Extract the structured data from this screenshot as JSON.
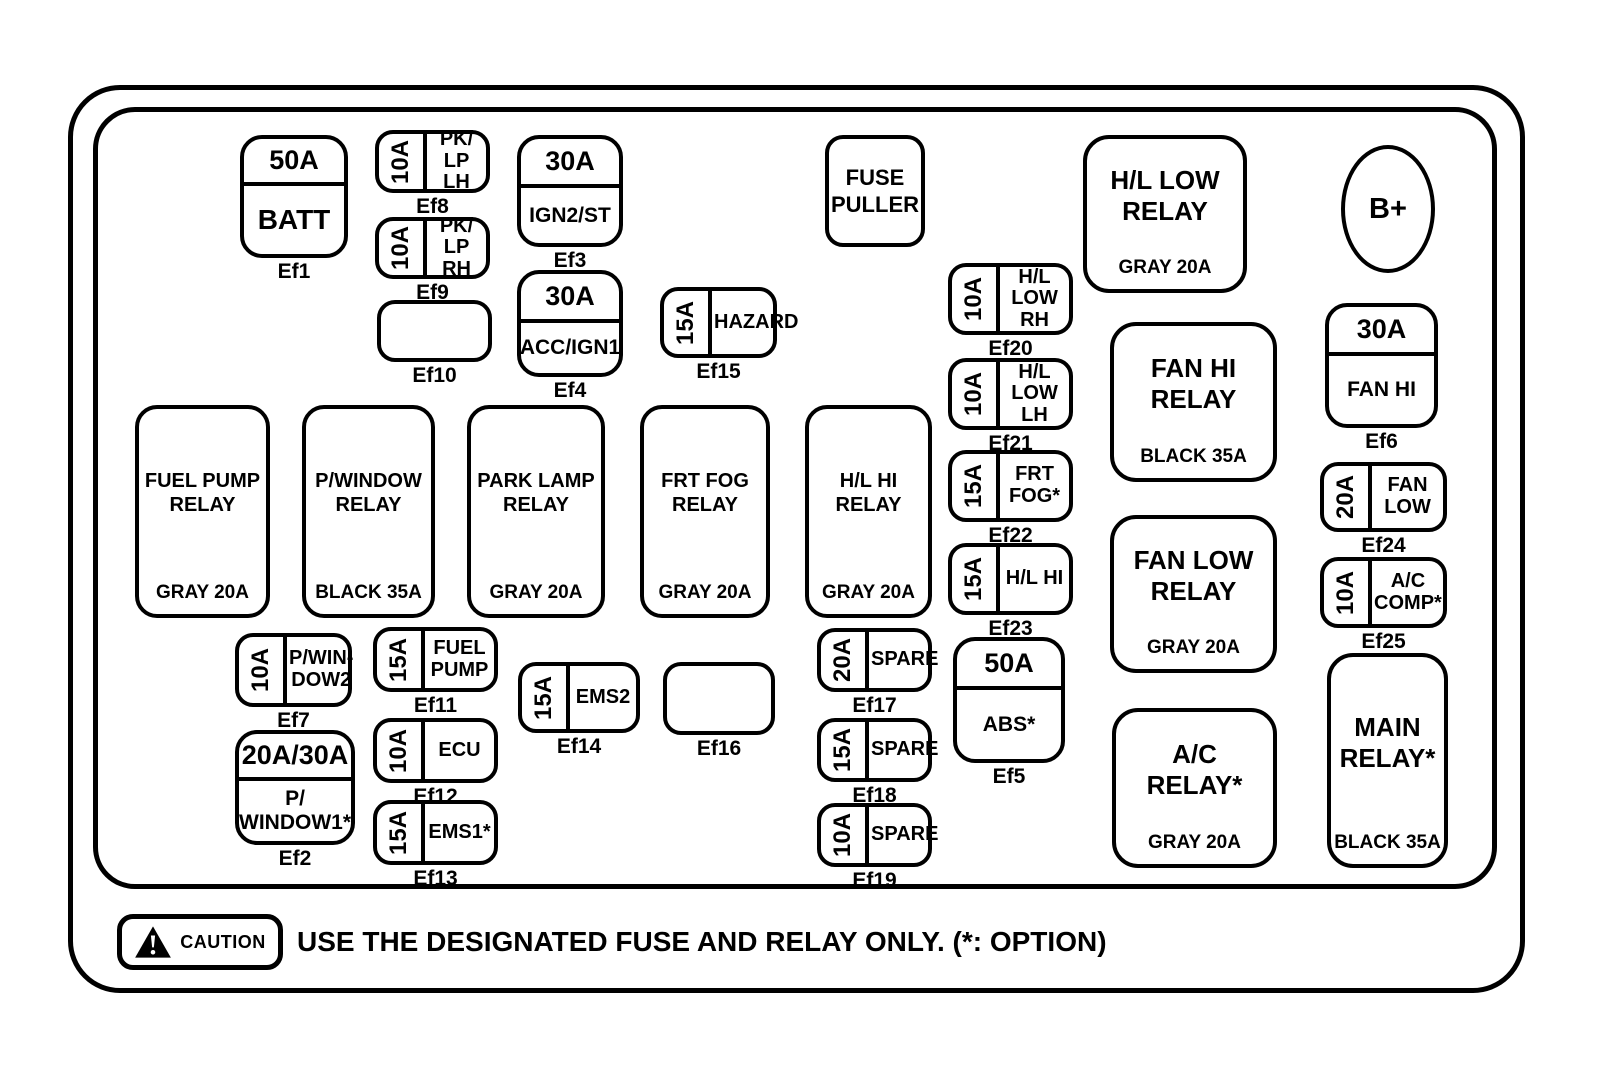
{
  "colors": {
    "line": "#000000",
    "background": "#ffffff"
  },
  "caution": {
    "badge": "CAUTION",
    "message": "USE THE DESIGNATED FUSE AND RELAY ONLY. (*: OPTION)"
  },
  "elements": [
    {
      "id": "fuse-ef1",
      "type": "split",
      "variant": "big-name",
      "amp": "50A",
      "name": "BATT",
      "label": "Ef1",
      "x": 240,
      "y": 135,
      "w": 108,
      "h": 123,
      "ampH": 43
    },
    {
      "id": "fuse-ef8",
      "type": "side",
      "amp": "10A",
      "name": "PK/\nLP LH",
      "label": "Ef8",
      "x": 375,
      "y": 130,
      "w": 115,
      "h": 63
    },
    {
      "id": "fuse-ef9",
      "type": "side",
      "amp": "10A",
      "name": "PK/\nLP RH",
      "label": "Ef9",
      "x": 375,
      "y": 217,
      "w": 115,
      "h": 62
    },
    {
      "id": "empty-slot-ef10",
      "type": "empty",
      "label": "Ef10",
      "x": 377,
      "y": 300,
      "w": 115,
      "h": 62
    },
    {
      "id": "fuse-ef3",
      "type": "split",
      "amp": "30A",
      "name": "IGN2/ST",
      "label": "Ef3",
      "x": 517,
      "y": 135,
      "w": 106,
      "h": 112,
      "ampH": 45
    },
    {
      "id": "fuse-ef4",
      "type": "split",
      "amp": "30A",
      "name": "ACC/IGN1",
      "label": "Ef4",
      "x": 517,
      "y": 270,
      "w": 106,
      "h": 107,
      "ampH": 45
    },
    {
      "id": "fuse-ef15",
      "type": "side",
      "amp": "15A",
      "name": "HAZARD",
      "label": "Ef15",
      "x": 660,
      "y": 287,
      "w": 117,
      "h": 71
    },
    {
      "id": "fuse-puller",
      "type": "plain",
      "name": "FUSE\nPULLER",
      "x": 825,
      "y": 135,
      "w": 100,
      "h": 112
    },
    {
      "id": "fuse-ef20",
      "type": "side",
      "amp": "10A",
      "name": "H/L LOW\nRH",
      "label": "Ef20",
      "x": 948,
      "y": 263,
      "w": 125,
      "h": 72
    },
    {
      "id": "fuse-ef21",
      "type": "side",
      "amp": "10A",
      "name": "H/L LOW\nLH",
      "label": "Ef21",
      "x": 948,
      "y": 358,
      "w": 125,
      "h": 72
    },
    {
      "id": "fuse-ef22",
      "type": "side",
      "amp": "15A",
      "name": "FRT\nFOG*",
      "label": "Ef22",
      "x": 948,
      "y": 450,
      "w": 125,
      "h": 72
    },
    {
      "id": "fuse-ef23",
      "type": "side",
      "amp": "15A",
      "name": "H/L HI",
      "label": "Ef23",
      "x": 948,
      "y": 543,
      "w": 125,
      "h": 72
    },
    {
      "id": "hl-low-relay",
      "type": "relay",
      "variant": "lg",
      "name": "H/L LOW\nRELAY",
      "spec": "GRAY 20A",
      "x": 1083,
      "y": 135,
      "w": 164,
      "h": 158
    },
    {
      "id": "b-plus-terminal",
      "type": "ellipse",
      "name": "B+",
      "x": 1341,
      "y": 145,
      "w": 94,
      "h": 128
    },
    {
      "id": "fuse-ef6",
      "type": "split",
      "amp": "30A",
      "name": "FAN HI",
      "label": "Ef6",
      "x": 1325,
      "y": 303,
      "w": 113,
      "h": 125,
      "ampH": 45
    },
    {
      "id": "fuel-pump-relay",
      "type": "relay",
      "name": "FUEL PUMP\nRELAY",
      "spec": "GRAY 20A",
      "x": 135,
      "y": 405,
      "w": 135,
      "h": 213
    },
    {
      "id": "p-window-relay",
      "type": "relay",
      "name": "P/WINDOW\nRELAY",
      "spec": "BLACK 35A",
      "x": 302,
      "y": 405,
      "w": 133,
      "h": 213
    },
    {
      "id": "park-lamp-relay",
      "type": "relay",
      "name": "PARK LAMP\nRELAY",
      "spec": "GRAY 20A",
      "x": 467,
      "y": 405,
      "w": 138,
      "h": 213
    },
    {
      "id": "frt-fog-relay",
      "type": "relay",
      "name": "FRT FOG\nRELAY",
      "spec": "GRAY 20A",
      "x": 640,
      "y": 405,
      "w": 130,
      "h": 213
    },
    {
      "id": "hl-hi-relay",
      "type": "relay",
      "name": "H/L HI\nRELAY",
      "spec": "GRAY 20A",
      "x": 805,
      "y": 405,
      "w": 127,
      "h": 213
    },
    {
      "id": "fan-hi-relay",
      "type": "relay",
      "variant": "lg",
      "name": "FAN HI\nRELAY",
      "spec": "BLACK 35A",
      "x": 1110,
      "y": 322,
      "w": 167,
      "h": 160
    },
    {
      "id": "fan-low-relay",
      "type": "relay",
      "variant": "lg",
      "name": "FAN LOW\nRELAY",
      "spec": "GRAY 20A",
      "x": 1110,
      "y": 515,
      "w": 167,
      "h": 158
    },
    {
      "id": "fuse-ef24",
      "type": "side",
      "amp": "20A",
      "name": "FAN\nLOW",
      "label": "Ef24",
      "x": 1320,
      "y": 462,
      "w": 127,
      "h": 70
    },
    {
      "id": "fuse-ef25",
      "type": "side",
      "amp": "10A",
      "name": "A/C\nCOMP*",
      "label": "Ef25",
      "x": 1320,
      "y": 557,
      "w": 127,
      "h": 71
    },
    {
      "id": "fuse-ef7",
      "type": "side",
      "amp": "10A",
      "name": "P/WIN-\nDOW2",
      "label": "Ef7",
      "x": 235,
      "y": 633,
      "w": 117,
      "h": 74
    },
    {
      "id": "fuse-ef2",
      "type": "split",
      "amp": "20A/30A",
      "name": "P/\nWINDOW1*",
      "label": "Ef2",
      "x": 235,
      "y": 730,
      "w": 120,
      "h": 115,
      "ampH": 43
    },
    {
      "id": "fuse-ef11",
      "type": "side",
      "amp": "15A",
      "name": "FUEL\nPUMP",
      "label": "Ef11",
      "x": 373,
      "y": 627,
      "w": 125,
      "h": 65
    },
    {
      "id": "fuse-ef12",
      "type": "side",
      "amp": "10A",
      "name": "ECU",
      "label": "Ef12",
      "x": 373,
      "y": 718,
      "w": 125,
      "h": 65
    },
    {
      "id": "fuse-ef13",
      "type": "side",
      "amp": "15A",
      "name": "EMS1*",
      "label": "Ef13",
      "x": 373,
      "y": 800,
      "w": 125,
      "h": 65
    },
    {
      "id": "fuse-ef14",
      "type": "side",
      "amp": "15A",
      "name": "EMS2",
      "label": "Ef14",
      "x": 518,
      "y": 662,
      "w": 122,
      "h": 71
    },
    {
      "id": "empty-slot-ef16",
      "type": "empty",
      "label": "Ef16",
      "x": 663,
      "y": 662,
      "w": 112,
      "h": 73
    },
    {
      "id": "fuse-ef17",
      "type": "side",
      "amp": "20A",
      "name": "SPARE",
      "label": "Ef17",
      "x": 817,
      "y": 628,
      "w": 115,
      "h": 64
    },
    {
      "id": "fuse-ef18",
      "type": "side",
      "amp": "15A",
      "name": "SPARE",
      "label": "Ef18",
      "x": 817,
      "y": 718,
      "w": 115,
      "h": 64
    },
    {
      "id": "fuse-ef19",
      "type": "side",
      "amp": "10A",
      "name": "SPARE",
      "label": "Ef19",
      "x": 817,
      "y": 803,
      "w": 115,
      "h": 64
    },
    {
      "id": "fuse-ef5",
      "type": "split",
      "amp": "50A",
      "name": "ABS*",
      "label": "Ef5",
      "x": 953,
      "y": 637,
      "w": 112,
      "h": 126,
      "ampH": 45
    },
    {
      "id": "ac-relay",
      "type": "relay",
      "variant": "lg",
      "name": "A/C\nRELAY*",
      "spec": "GRAY 20A",
      "x": 1112,
      "y": 708,
      "w": 165,
      "h": 160
    },
    {
      "id": "main-relay",
      "type": "relay",
      "variant": "lg",
      "name": "MAIN\nRELAY*",
      "spec": "BLACK 35A",
      "x": 1327,
      "y": 653,
      "w": 121,
      "h": 215
    }
  ]
}
